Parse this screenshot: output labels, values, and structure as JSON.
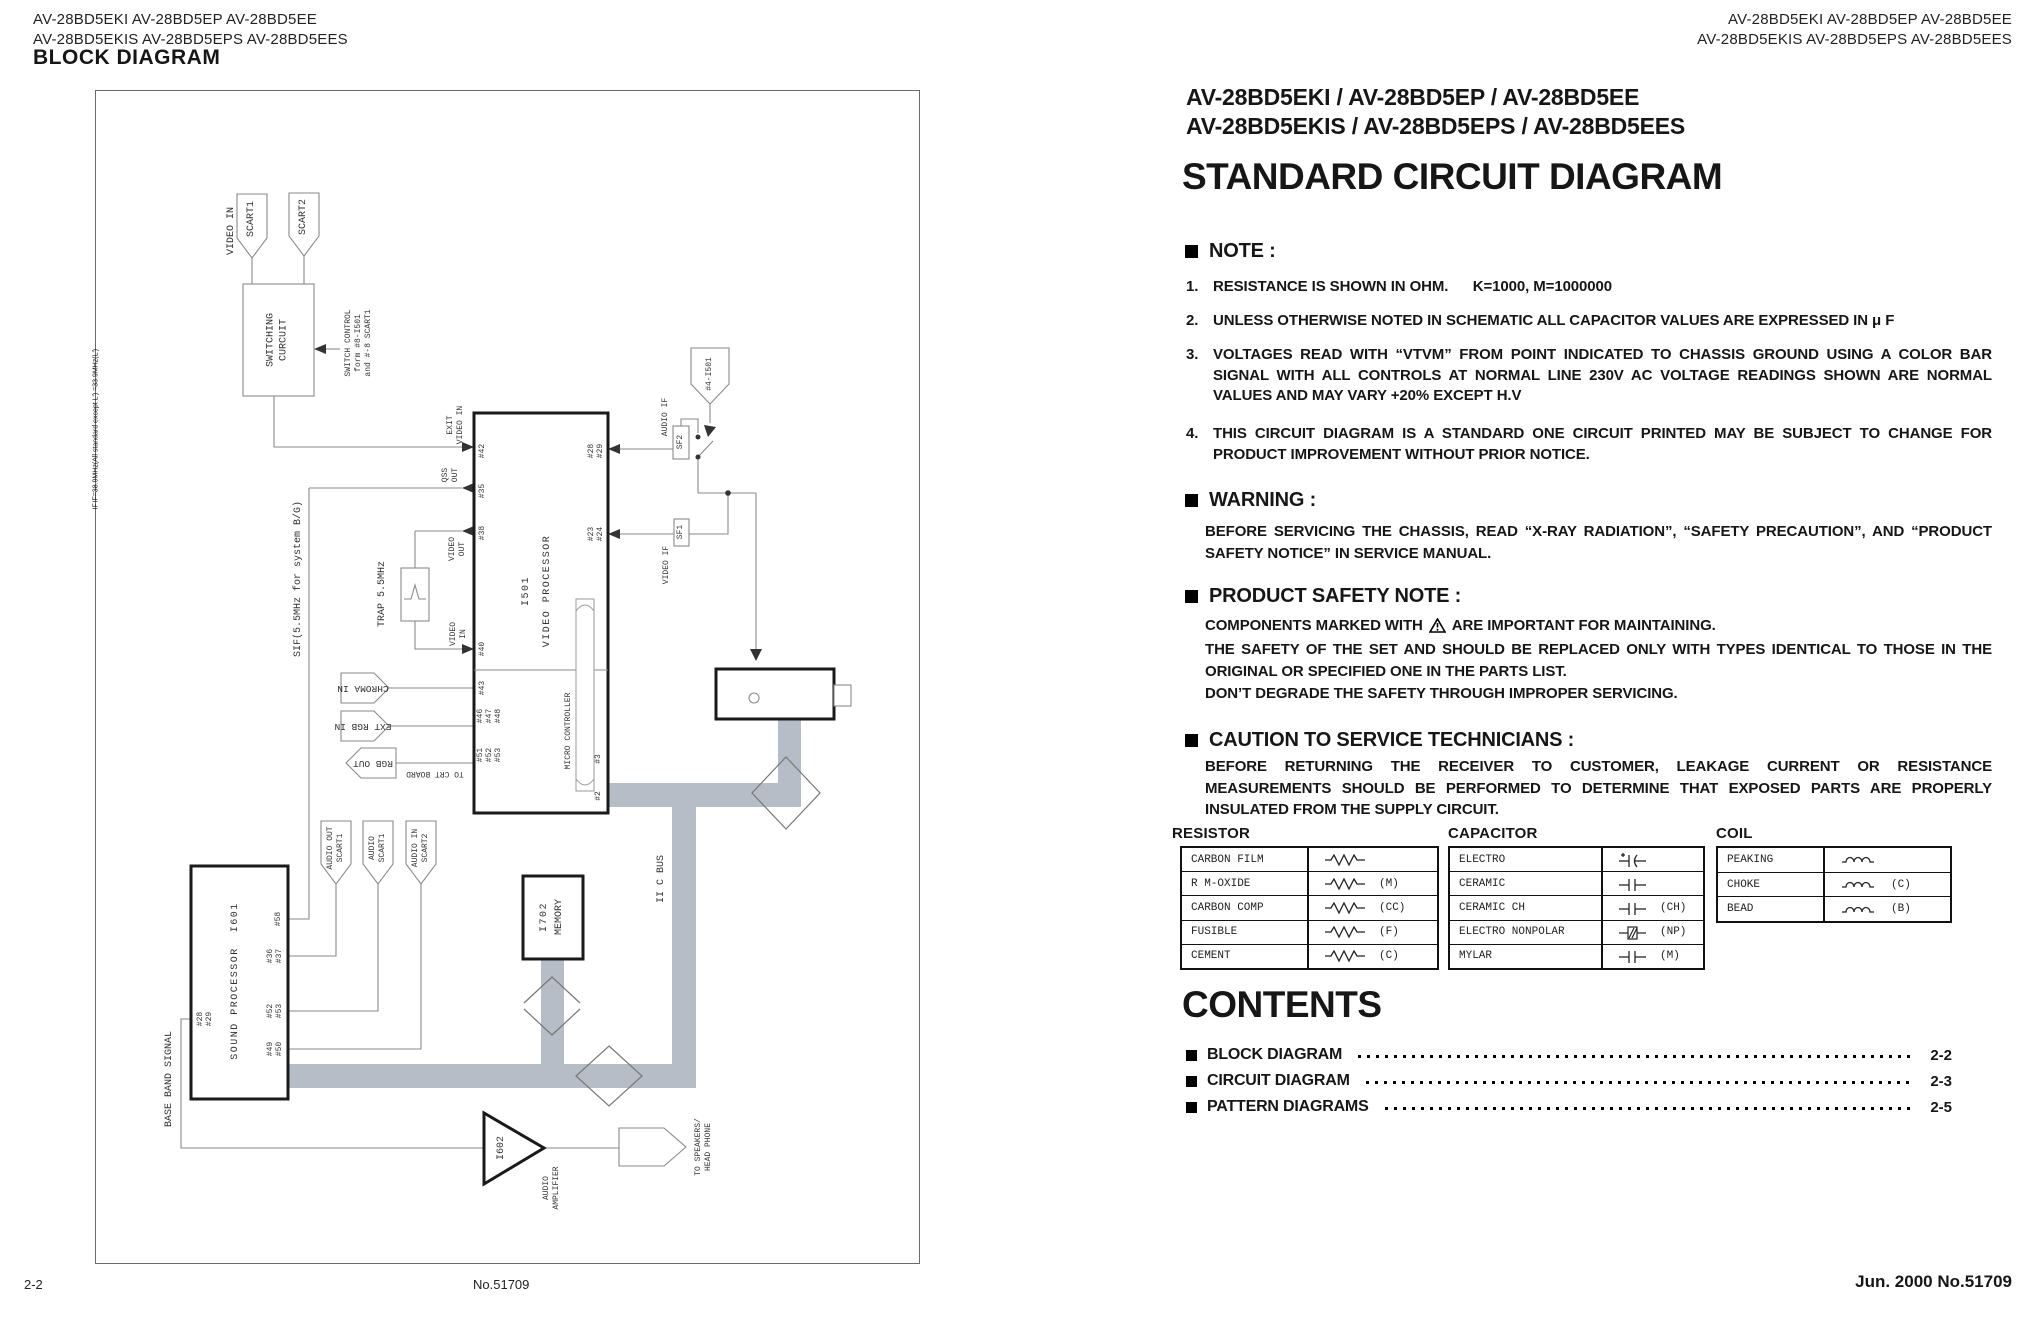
{
  "page": {
    "header_left": "AV-28BD5EKI  AV-28BD5EP  AV-28BD5EE\nAV-28BD5EKIS AV-28BD5EPS AV-28BD5EES",
    "header_right": "AV-28BD5EKI  AV-28BD5EP  AV-28BD5EE\nAV-28BD5EKIS AV-28BD5EPS AV-28BD5EES",
    "footer": {
      "left": "2-2",
      "center": "No.51709",
      "right": "Jun. 2000  No.51709"
    }
  },
  "left_page": {
    "section_title": "BLOCK DIAGRAM",
    "diagram": {
      "video_in": "VIDEO IN",
      "scart1": "SCART1",
      "scart2": "SCART2",
      "switching_circuit": "SWITCHING\nCURCUIT",
      "switch_control": "SWITCH CONTROL\nform #8-I501\nand #-8 SCART1",
      "exit_video_in": "EXIT\nVIDEO IN",
      "qss_out": "QSS\nOUT",
      "video_out": "VIDEO\nOUT",
      "trap": "TRAP 5.5MHz",
      "video_in_pin": "VIDEO\nIN",
      "sif_label": "SIF(5.5MHz for system B/G)",
      "chroma_in": "CHROMA IN",
      "ext_rgb_in": "EXT RGB IN",
      "rgb_out": "RGB OUT",
      "to_crt_board": "TO CRT BOARD",
      "i501": "I501",
      "video_processor": "VIDEO PROCESSOR",
      "micro_controller": "MICRO CONTROLLER",
      "audio_if": "AUDIO IF",
      "video_if": "VIDEO IF",
      "sf1": "SF1",
      "sf2": "SF2",
      "conn_4_i501": "#4-I501",
      "if_note": "IF=38.9MHz(All standard except L')\n  =33.9MHz(L')",
      "tuner_if": "IF",
      "iic_bus": "II C BUS",
      "i702": "I702",
      "memory": "MEMORY",
      "sound_processor": "SOUND PROCESSOR  I601",
      "base_band": "BASE BAND SIGNAL",
      "audio_out_scart1": "AUDIO OUT\nSCART1",
      "audio_scart1": "AUDIO\nSCART1",
      "audio_in_scart2": "AUDIO IN\nSCART2",
      "i602": "I602",
      "audio_amplifier": "AUDIO\nAMPLIFIER",
      "to_speakers": "TO SPEAKERS/\nHEAD PHONE",
      "pins": {
        "p42": "#42",
        "p35": "#35",
        "p38": "#38",
        "p40": "#40",
        "p43": "#43",
        "p46": "#46",
        "p47": "#47",
        "p48": "#48",
        "p51": "#51",
        "p52": "#52",
        "p53": "#53",
        "p28": "#28",
        "p29": "#29",
        "p23": "#23",
        "p24": "#24",
        "p3": "#3",
        "p2": "#2",
        "sp28": "#28",
        "sp29": "#29",
        "sp58": "#58",
        "sp36": "#36",
        "sp37": "#37",
        "sp52": "#52",
        "sp53": "#53",
        "sp49": "#49",
        "sp50": "#50"
      }
    }
  },
  "right_page": {
    "model_line1": "AV-28BD5EKI / AV-28BD5EP / AV-28BD5EE",
    "model_line2": "AV-28BD5EKIS / AV-28BD5EPS / AV-28BD5EES",
    "title": "STANDARD CIRCUIT DIAGRAM",
    "note": {
      "heading": "NOTE :",
      "items": [
        {
          "num": "1.",
          "text": "RESISTANCE IS SHOWN IN OHM.      K=1000, M=1000000"
        },
        {
          "num": "2.",
          "text": "UNLESS OTHERWISE NOTED IN SCHEMATIC ALL CAPACITOR VALUES ARE EXPRESSED IN  μ F"
        },
        {
          "num": "3.",
          "text": "VOLTAGES READ WITH “VTVM” FROM POINT INDICATED TO CHASSIS GROUND USING A COLOR BAR SIGNAL WITH ALL CONTROLS AT NORMAL LINE 230V AC VOLTAGE READINGS SHOWN ARE NORMAL VALUES AND MAY VARY +20% EXCEPT H.V"
        },
        {
          "num": "4.",
          "text": "THIS CIRCUIT DIAGRAM IS A STANDARD ONE CIRCUIT PRINTED MAY BE SUBJECT TO CHANGE FOR PRODUCT IMPROVEMENT WITHOUT PRIOR NOTICE."
        }
      ]
    },
    "warning": {
      "heading": "WARNING :",
      "body": "BEFORE SERVICING THE CHASSIS, READ “X-RAY RADIATION”, “SAFETY PRECAUTION”, AND “PRODUCT SAFETY NOTICE” IN SERVICE MANUAL."
    },
    "product_safety": {
      "heading": "PRODUCT SAFETY NOTE :",
      "line1a": "COMPONENTS MARKED WITH",
      "line1b": "ARE IMPORTANT FOR MAINTAINING.",
      "para": "THE SAFETY OF THE SET AND SHOULD BE REPLACED ONLY WITH TYPES IDENTICAL TO THOSE IN THE ORIGINAL OR SPECIFIED ONE IN THE PARTS LIST.",
      "last": "DON’T DEGRADE THE SAFETY THROUGH IMPROPER SERVICING."
    },
    "caution": {
      "heading": "CAUTION TO SERVICE TECHNICIANS :",
      "body": "BEFORE RETURNING THE RECEIVER TO CUSTOMER, LEAKAGE CURRENT OR RESISTANCE MEASUREMENTS SHOULD BE PERFORMED TO DETERMINE THAT EXPOSED PARTS ARE PROPERLY INSULATED FROM THE SUPPLY CIRCUIT."
    },
    "tables": {
      "resistor": {
        "title": "RESISTOR",
        "rows": [
          {
            "name": "CARBON FILM",
            "code": ""
          },
          {
            "name": "R M-OXIDE",
            "code": "(M)"
          },
          {
            "name": "CARBON COMP",
            "code": "(CC)"
          },
          {
            "name": "FUSIBLE",
            "code": "(F)"
          },
          {
            "name": "CEMENT",
            "code": "(C)"
          }
        ]
      },
      "capacitor": {
        "title": "CAPACITOR",
        "rows": [
          {
            "name": "ELECTRO",
            "code": ""
          },
          {
            "name": "CERAMIC",
            "code": ""
          },
          {
            "name": "CERAMIC CH",
            "code": "(CH)"
          },
          {
            "name": "ELECTRO NONPOLAR",
            "code": "(NP)"
          },
          {
            "name": "MYLAR",
            "code": "(M)"
          }
        ]
      },
      "coil": {
        "title": "COIL",
        "rows": [
          {
            "name": "PEAKING",
            "code": ""
          },
          {
            "name": "CHOKE",
            "code": "(C)"
          },
          {
            "name": "BEAD",
            "code": "(B)"
          }
        ]
      }
    },
    "contents": {
      "heading": "CONTENTS",
      "items": [
        {
          "label": "BLOCK DIAGRAM",
          "page": "2-2"
        },
        {
          "label": "CIRCUIT DIAGRAM",
          "page": "2-3"
        },
        {
          "label": "PATTERN DIAGRAMS",
          "page": "2-5"
        }
      ]
    }
  }
}
